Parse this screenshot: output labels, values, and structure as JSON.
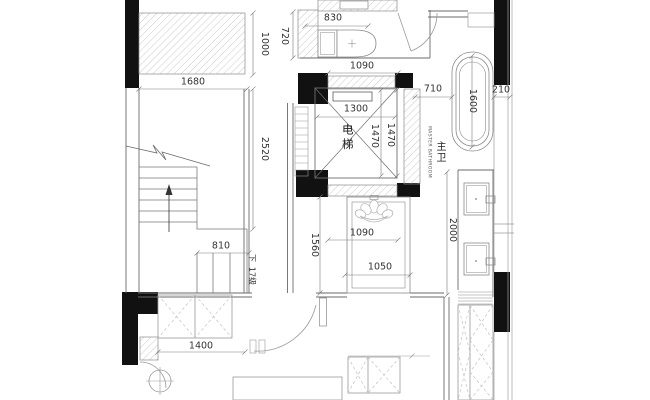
{
  "meta": {
    "type": "architectural-floor-plan",
    "units": "mm"
  },
  "palette": {
    "wall_fill": "#111111",
    "wall_line": "#5a5a5a",
    "fixture_line": "#8a8a8a",
    "hatch_line": "#a8a8a8",
    "dash_line": "#bcbcbc",
    "dim_line": "#7a7a7a",
    "text": "#333333"
  },
  "rooms": {
    "elevator_label": "电梯",
    "master_bathroom_label_cn": "主卫",
    "master_bathroom_label_en": "MASTER BATHROOM",
    "stairs_down_label": "下",
    "stairs_steps_label": "17级"
  },
  "dimensions": {
    "toilet_width": "830",
    "wall_top_1000": "1000",
    "wall_top_720": "720",
    "closet_width": "1680",
    "lobby_width_top": "1090",
    "tub_offset": "710",
    "tub_length": "1600",
    "wall_edge": "210",
    "elevator_width": "1300",
    "elevator_depth_inner": "1470",
    "elevator_depth_outer": "1470",
    "stairwell_depth": "2520",
    "stair_flight_width": "810",
    "shower_depth": "1560",
    "shower_width": "1090",
    "shower_opening": "1050",
    "vanity_run": "2000",
    "closet_bottom_width": "1400"
  }
}
